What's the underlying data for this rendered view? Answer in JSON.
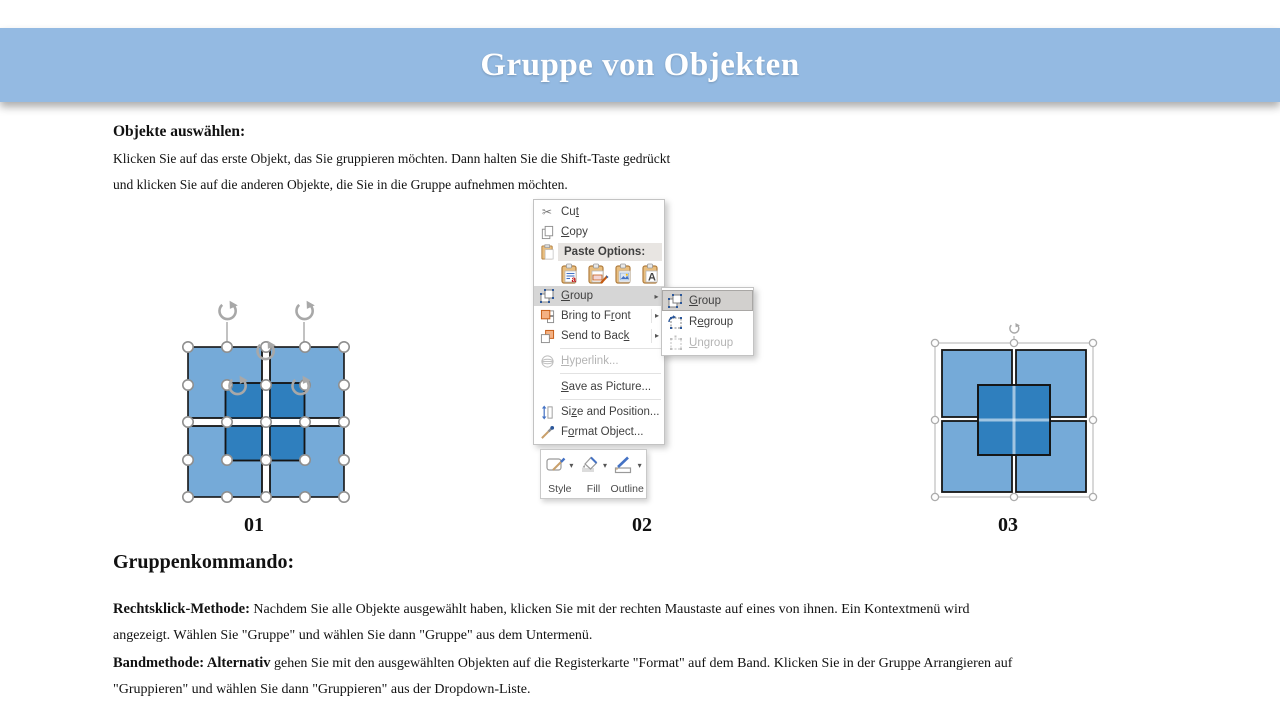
{
  "slide": {
    "title": "Gruppe von Objekten",
    "select_section": {
      "heading": "Objekte auswählen:",
      "line1": "Klicken Sie auf das erste Objekt, das Sie gruppieren möchten. Dann halten Sie die Shift-Taste gedrückt",
      "line2": "und klicken Sie auf die anderen Objekte, die Sie in die Gruppe aufnehmen möchten."
    },
    "figure_labels": [
      "01",
      "02",
      "03"
    ],
    "group_section": {
      "heading": "Gruppenkommando:",
      "p1_bold": "Rechtsklick-Methode:",
      "p1_line1": " Nachdem Sie alle Objekte ausgewählt haben, klicken Sie mit der rechten Maustaste auf eines von ihnen. Ein Kontextmenü wird",
      "p1_line2": "angezeigt. Wählen Sie \"Gruppe\" und wählen Sie dann \"Gruppe\" aus dem Untermenü.",
      "p2_bold": "Bandmethode: Alternativ",
      "p2_line1": " gehen Sie mit den ausgewählten Objekten auf die Registerkarte \"Format\" auf dem Band. Klicken Sie in der Gruppe Arrangieren auf",
      "p2_line2": "\"Gruppieren\" und wählen Sie dann \"Gruppieren\" aus der Dropdown-Liste."
    }
  },
  "context_menu": {
    "items": {
      "cut": {
        "pre": "Cu",
        "key": "t",
        "post": ""
      },
      "copy": {
        "pre": "",
        "key": "C",
        "post": "opy"
      },
      "paste_options": "Paste Options:",
      "group": {
        "pre": "",
        "key": "G",
        "post": "roup"
      },
      "bring_to_front": {
        "pre": "Bring to F",
        "key": "r",
        "post": "ont"
      },
      "send_to_back": {
        "pre": "Send to Bac",
        "key": "k",
        "post": ""
      },
      "hyperlink": {
        "pre": "",
        "key": "H",
        "post": "yperlink..."
      },
      "save_as_picture": {
        "pre": "",
        "key": "S",
        "post": "ave as Picture..."
      },
      "size_and_position": {
        "pre": "Si",
        "key": "z",
        "post": "e and Position..."
      },
      "format_object": {
        "pre": "F",
        "key": "o",
        "post": "rmat Object..."
      }
    },
    "submenu": {
      "group": {
        "pre": "",
        "key": "G",
        "post": "roup"
      },
      "regroup": {
        "pre": "R",
        "key": "e",
        "post": "group"
      },
      "ungroup": {
        "pre": "",
        "key": "U",
        "post": "ngroup"
      }
    },
    "mini_toolbar": {
      "style": "Style",
      "fill": "Fill",
      "outline": "Outline"
    }
  },
  "icons": {
    "scissors": "✂",
    "submenu_arrow": "▸",
    "dropdown_arrow": "▾"
  },
  "colors": {
    "banner": "#94BAE2",
    "square_light": "#75AAD8",
    "square_dark": "#2F7FBE",
    "menu_highlight": "#D6D6D6",
    "accent_blue": "#2B579A",
    "clipboard_tan": "#E9BE7F"
  }
}
